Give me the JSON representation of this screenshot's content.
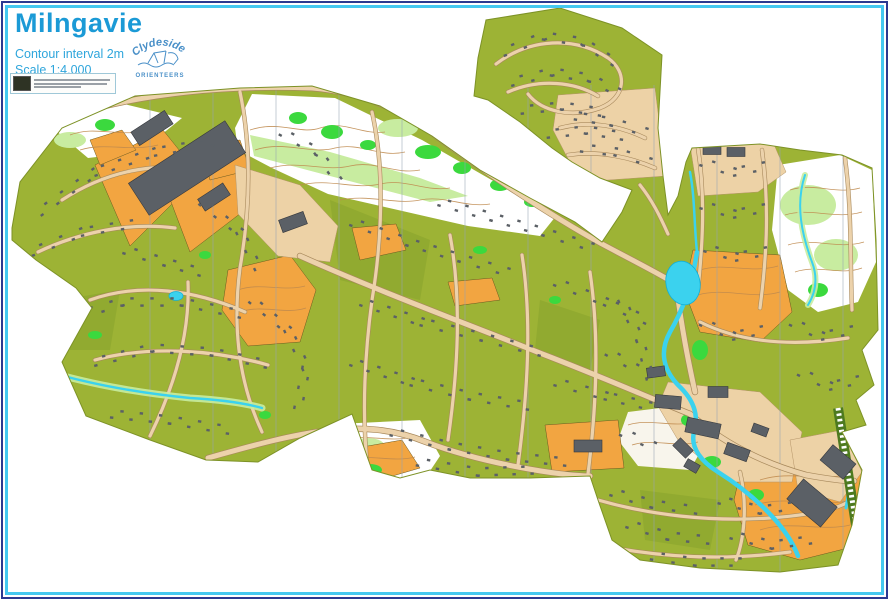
{
  "header": {
    "title": "Milngavie",
    "contour_note": "Contour interval 2m",
    "scale_note": "Scale 1:4,000"
  },
  "logo": {
    "club_name_top": "Clydeside",
    "club_name_bottom": "ORIENTEERS"
  },
  "map": {
    "colors": {
      "title_blue": "#1b9ad6",
      "subtitle_blue": "#2fa6dc",
      "logo_blue": "#4a90c8",
      "border_outer": "#2b3990",
      "border_inner": "#45c8f0",
      "residential": "#9db335",
      "residential_dark": "#87a22b",
      "open_orange": "#f2a541",
      "paved": "#edd2a6",
      "road_fill": "#ecd2ab",
      "road_casing": "#a8895c",
      "forest_white": "#ffffff",
      "veg_bright": "#3bd93e",
      "veg_light": "#c8eca0",
      "water": "#3bd2ee",
      "water_edge": "#12b0d8",
      "building": "#5b6066",
      "building_edge": "#35383d",
      "contour": "#bf8a4e",
      "north_line": "#98a4b2",
      "railway": "#4d7a1f",
      "boundary": "#7d9226"
    }
  }
}
